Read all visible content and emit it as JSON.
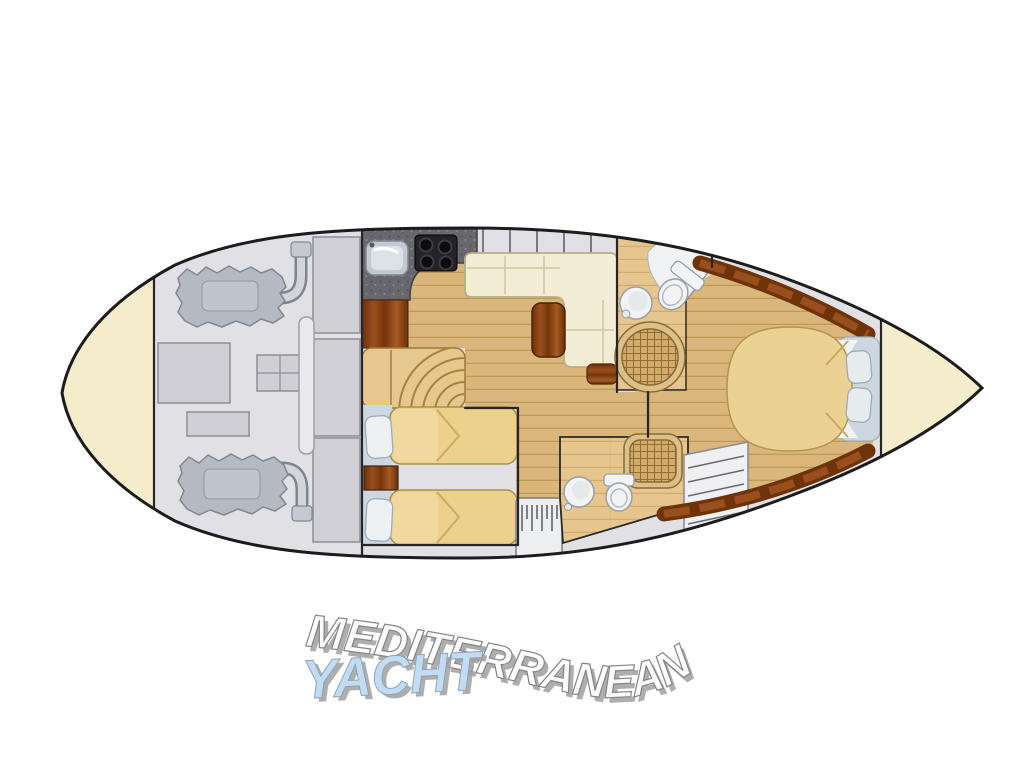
{
  "watermark": {
    "line1": "MEDITERRANEAN",
    "line2": "YACHT",
    "line1_color": "#fcfcfc",
    "line2_color": "#c2dcf4"
  },
  "palette": {
    "hull_fill": "#f4ecca",
    "hull_outline": "#1f1f1f",
    "deck_gray": "#e1e1e5",
    "wood_floor": "#d8b67c",
    "bathroom_floor": "#e6c58e",
    "mahogany": "#7a3a10",
    "sofa_cream": "#f3edd6",
    "bed_tan": "#ecd08c",
    "counter_dark": "#67676d",
    "fixture_white": "#f1f2f3",
    "pillow_blue": "#ccd7e1",
    "rattan": "#d2ab6c",
    "engine_gray": "#b5b9c1"
  },
  "plan": {
    "type": "yacht-deck-floor-plan",
    "sections": [
      {
        "name": "stern-lazarette",
        "items": []
      },
      {
        "name": "engine-room",
        "items": [
          "port-engine",
          "starboard-engine",
          "exhaust-pipes",
          "tank",
          "battery-box",
          "storage-lockers"
        ]
      },
      {
        "name": "galley",
        "items": [
          "sink",
          "four-burner-stove",
          "counter",
          "wood-cabinet"
        ]
      },
      {
        "name": "salon",
        "items": [
          "l-shaped-sofa",
          "wood-table",
          "footstool",
          "curved-stairs",
          "window-row"
        ]
      },
      {
        "name": "twin-guest-cabin",
        "items": [
          "twin-bed",
          "twin-bed",
          "nightstand",
          "pillows"
        ]
      },
      {
        "name": "companionway-steps",
        "items": []
      },
      {
        "name": "aft-bathroom",
        "items": [
          "washbasin",
          "toilet",
          "square-shower"
        ]
      },
      {
        "name": "forward-bathroom",
        "items": [
          "washbasin",
          "toilet",
          "round-shower"
        ]
      },
      {
        "name": "master-cabin",
        "items": [
          "island-double-bed",
          "pillows",
          "head-platform",
          "louvered-locker",
          "mahogany-trim"
        ]
      },
      {
        "name": "bow-locker",
        "items": []
      }
    ]
  }
}
